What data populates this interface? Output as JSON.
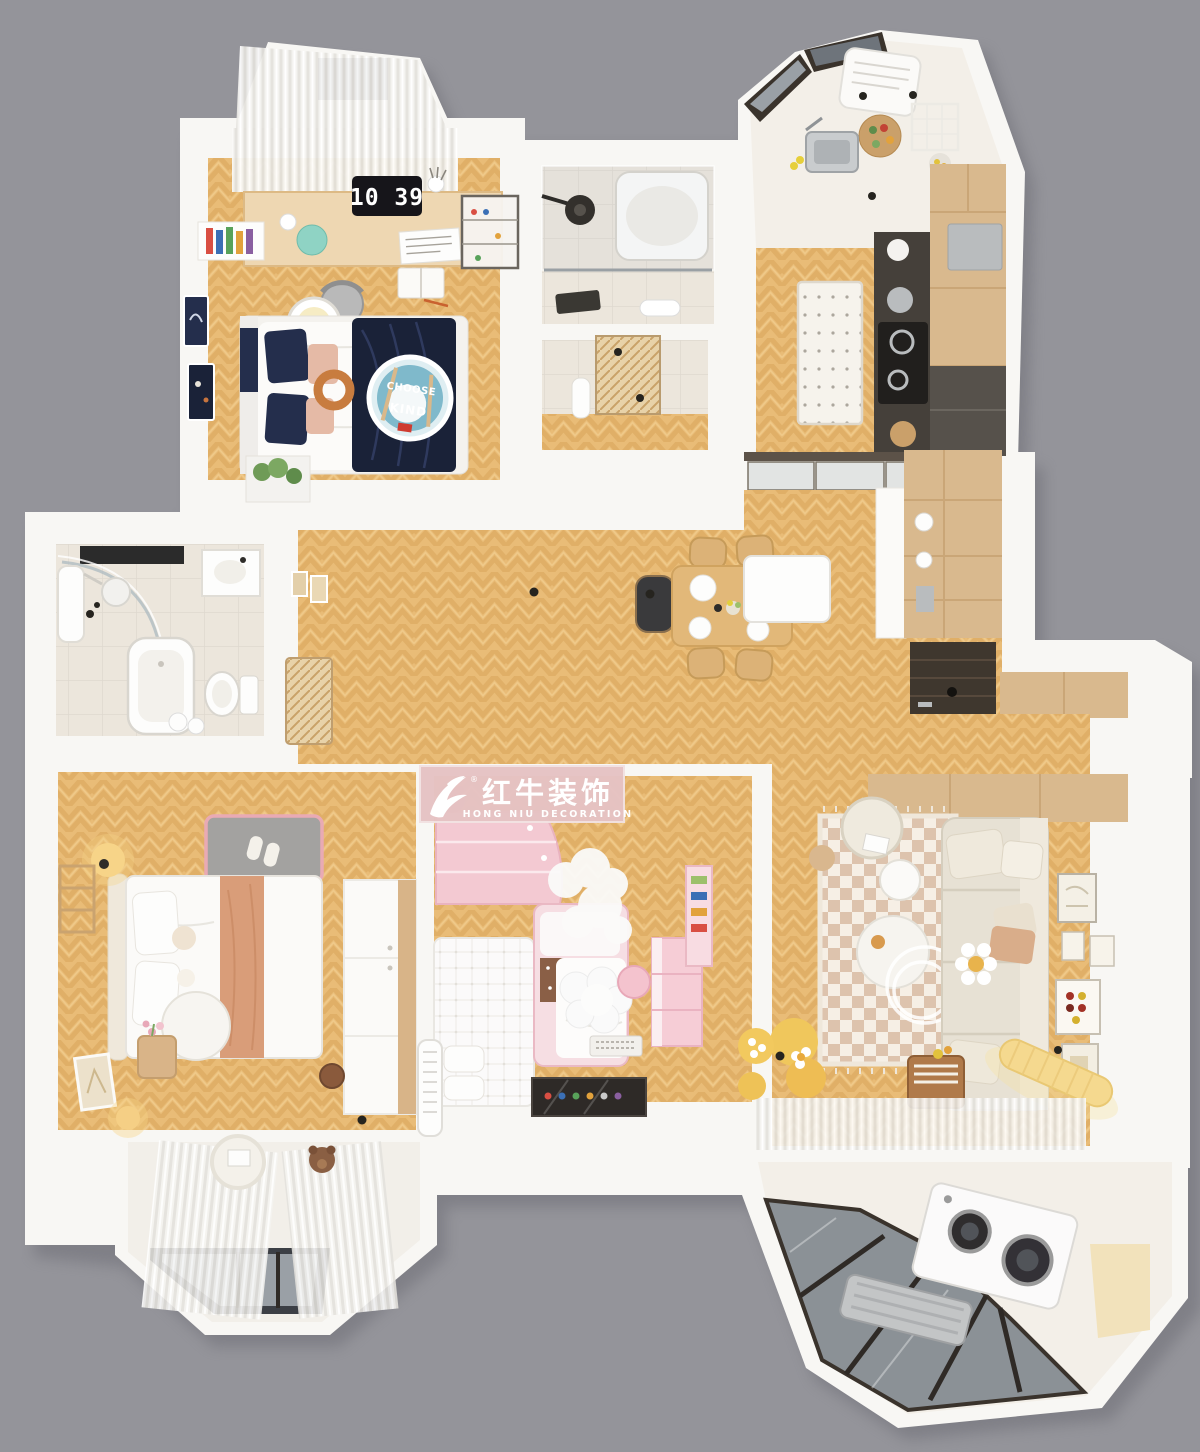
{
  "watermark": {
    "brand_cn": "红牛装饰",
    "brand_en": "HONG NIU DECORATION",
    "registered": "®"
  },
  "desk_clock": {
    "time": "10 39"
  },
  "rug_text": {
    "line1": "CHOOSE",
    "line2": "KIND"
  },
  "colors": {
    "bg": "#94949a",
    "wall": "#f8f7f4",
    "wood": "#e9bc77",
    "woodline": "#d5a055",
    "woodlight": "#f3cf92",
    "cab": "#d9b98e",
    "cabline": "#c6a172",
    "tile": "#ece6dc",
    "kfloor": "#f3efe8",
    "dark": "#45403a",
    "glass": "#9aa0a6",
    "glassd": "#6e747b",
    "navy": "#242e4c",
    "navyd": "#1a2238",
    "blush": "#e5baa6",
    "salmon": "#d99d79",
    "plogo": "#e6c3c4",
    "pkids": "#f3c9d2",
    "sofa": "#e7e1d4",
    "rugbase": "#f6efe5",
    "rugcheck": "#d9bba4",
    "gmat": "#a3a2a0",
    "ptrim": "#e9aab4",
    "glow": "#f7d488",
    "blue": "#7fb9cb"
  }
}
